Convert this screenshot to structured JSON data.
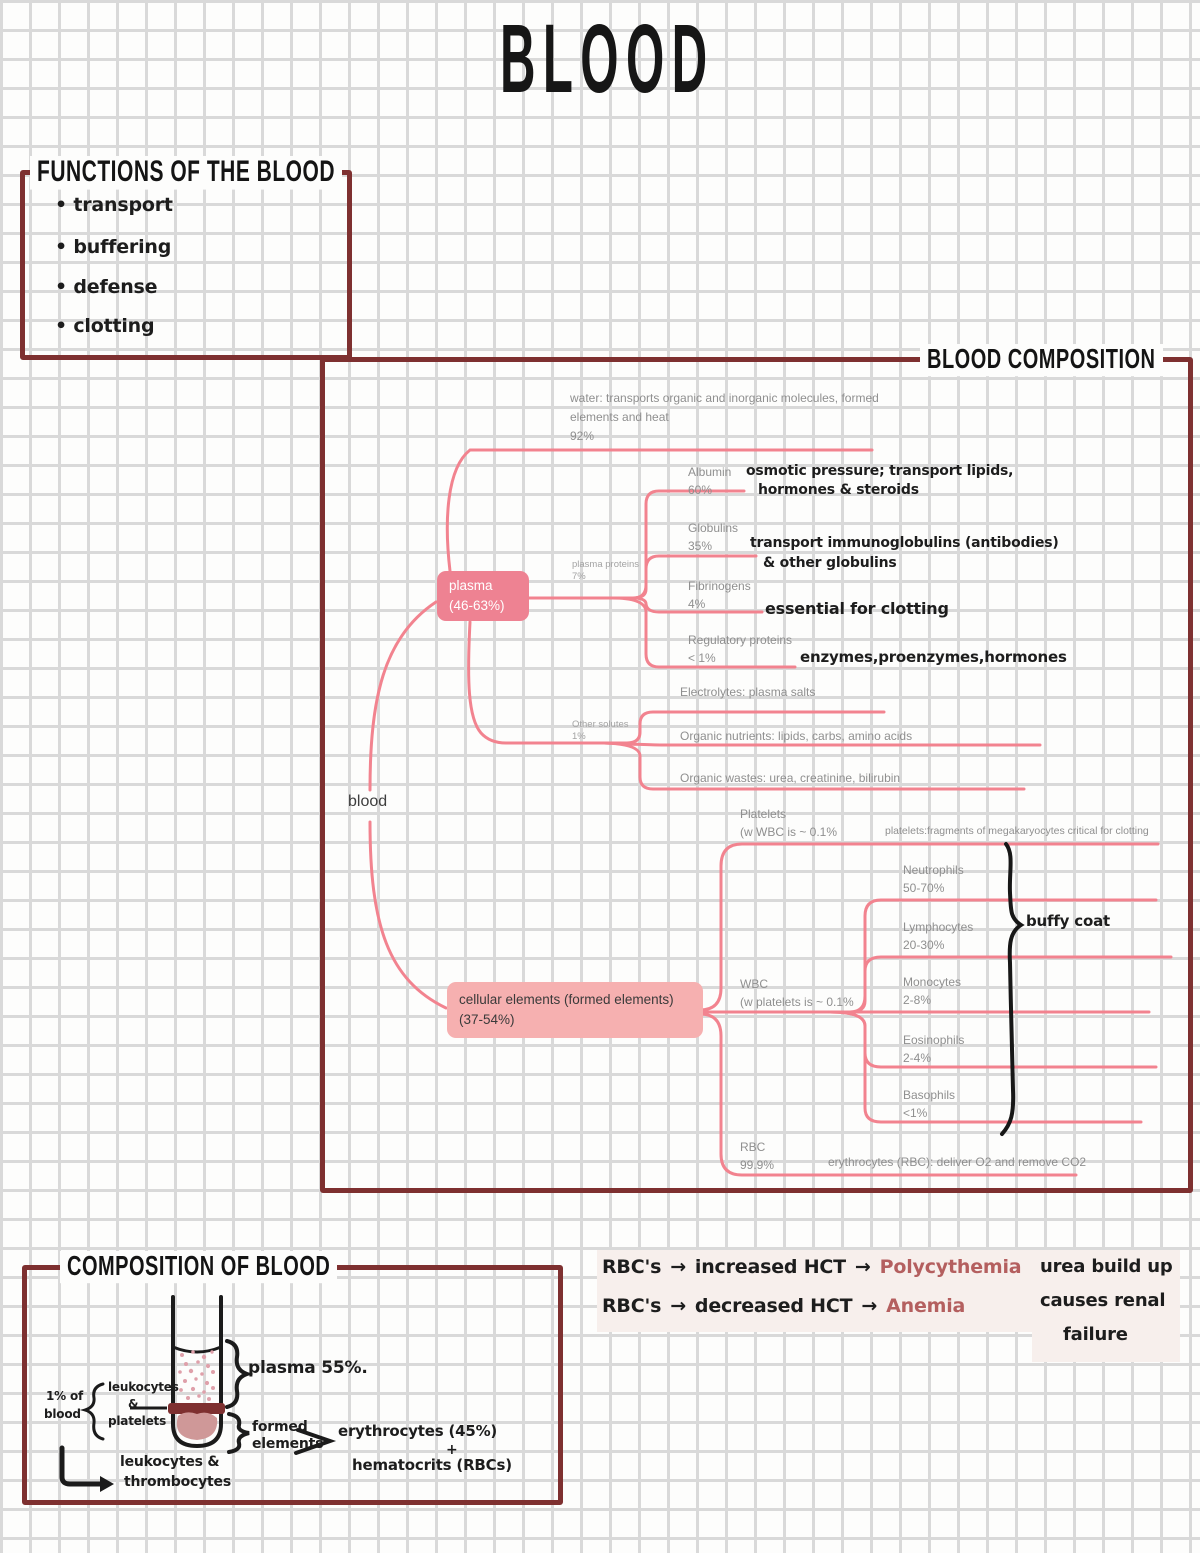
{
  "page_title": "BLOOD",
  "functions": {
    "title": "FUNCTIONS OF THE BLOOD",
    "items": [
      "transport",
      "buffering",
      "defense",
      "clotting"
    ]
  },
  "composition": {
    "title": "BLOOD COMPOSITION",
    "root_label": "blood",
    "plasma_node": {
      "line1": "plasma",
      "line2": "(46-63%)"
    },
    "cellular_node": {
      "line1": "cellular elements (formed elements)",
      "line2": "(37-54%)"
    },
    "water": {
      "line1": "water: transports organic and inorganic molecules, formed",
      "line2": "elements and heat",
      "pct": "92%"
    },
    "plasma_proteins": {
      "label": "plasma proteins",
      "pct": "7%"
    },
    "pp_children": [
      {
        "name": "Albumin",
        "pct": "60%",
        "note1": "osmotic pressure; transport lipids,",
        "note2": "hormones & steroids"
      },
      {
        "name": "Globulins",
        "pct": "35%",
        "note1": "transport immunoglobulins (antibodies)",
        "note2": "& other globulins"
      },
      {
        "name": "Fibrinogens",
        "pct": "4%",
        "note1": "essential for clotting",
        "note2": ""
      },
      {
        "name": "Regulatory proteins",
        "pct": "< 1%",
        "note1": "enzymes,proenzymes,hormones",
        "note2": ""
      }
    ],
    "other_solutes": {
      "label": "Other solutes",
      "pct": "1%"
    },
    "os_children": [
      "Electrolytes: plasma salts",
      "Organic nutrients: lipids, carbs, amino acids",
      "Organic wastes: urea, creatinine, bilirubin"
    ],
    "platelets": {
      "name": "Platelets",
      "sub": "(w WBC is ~ 0.1%",
      "note": "platelets:fragments of megakaryocytes critical for clotting"
    },
    "wbc": {
      "name": "WBC",
      "sub": "(w platelets is ~  0.1%"
    },
    "wbc_children": [
      {
        "name": "Neutrophils",
        "pct": "50-70%"
      },
      {
        "name": "Lymphocytes",
        "pct": "20-30%"
      },
      {
        "name": "Monocytes",
        "pct": "2-8%"
      },
      {
        "name": "Eosinophils",
        "pct": "2-4%"
      },
      {
        "name": "Basophils",
        "pct": "<1%"
      }
    ],
    "buffy_label": "buffy coat",
    "rbc": {
      "name": "RBC",
      "pct": "99.9%",
      "note": "erythrocytes (RBC): deliver O2 and remove CO2"
    }
  },
  "tube_box": {
    "title": "COMPOSITION OF BLOOD",
    "plasma_label": "plasma 55%.",
    "formed_line1": "formed",
    "formed_line2": "elements",
    "erythrocytes": "erythrocytes (45%)",
    "plus": "+",
    "hematocrits": "hematocrits (RBCs)",
    "left_line1": "1% of",
    "left_line2": "blood",
    "brace_line1": "leukocytes",
    "brace_amp": "&",
    "brace_line2": "platelets",
    "hook_line1": "leukocytes &",
    "hook_line2": "thrombocytes"
  },
  "notes": {
    "arrow": "→",
    "row1": {
      "a": "RBC's",
      "b": "increased HCT",
      "c": "Polycythemia"
    },
    "row2": {
      "a": "RBC's",
      "b": "decreased HCT",
      "c": "Anemia"
    },
    "urea": [
      "urea build up",
      "causes renal",
      "failure"
    ]
  },
  "colors": {
    "maroon": "#7e3030",
    "pink_line": "#f2838f",
    "plasma_box": "#ee8292",
    "cellular_box": "#f6b0b0",
    "gray_text": "#8f8f8f",
    "accent_handwriting": "#b45f5f",
    "highlight": "#f7efec"
  }
}
